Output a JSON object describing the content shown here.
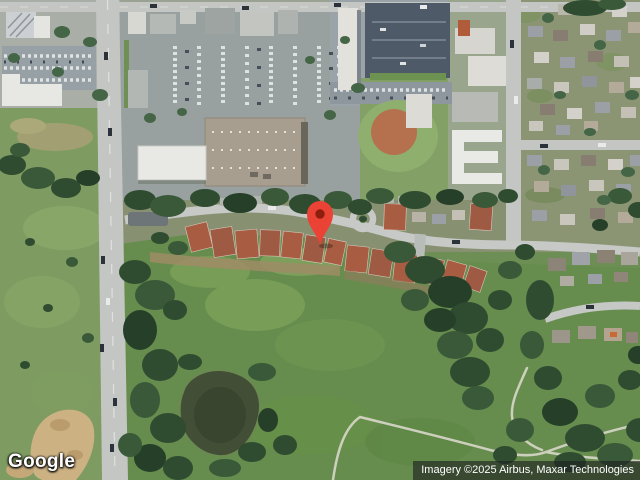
{
  "overlays": {
    "logo_text": "Google",
    "attribution_text": "Imagery ©2025 Airbus, Maxar Technologies"
  },
  "marker": {
    "color": "#EA4335",
    "dot_color": "#8D1E0D"
  },
  "palette": {
    "field_green": "#7e9b61",
    "park_green": "#668c4e",
    "tree_dark": "#2f4c31",
    "pond_water": "#424e36",
    "road_gray": "#c3c6c3",
    "asphalt": "#98a1a0",
    "dark_lot": "#4e5a68",
    "warehouse_roof": "#a79e8f",
    "building_white": "#e8e8e4",
    "condo_roof": "#a85c42",
    "infield_clay": "#b5714e",
    "sand": "#ccb183",
    "trail": "#ccd0bc"
  }
}
